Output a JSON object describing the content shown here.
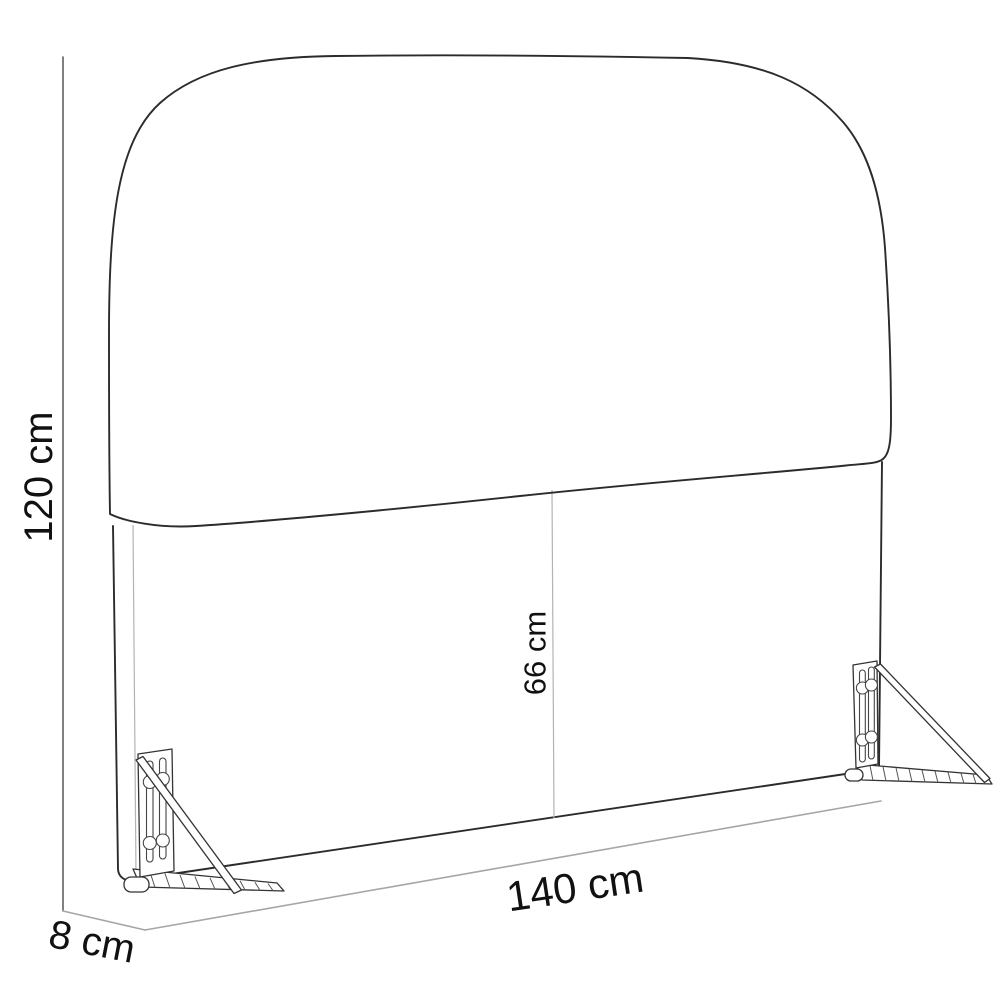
{
  "diagram": {
    "alt": "Line drawing of an upholstered headboard with two wall-mount brackets and dimension labels",
    "style": {
      "background": "#ffffff",
      "outline_color": "#2b2b2b",
      "seam_color": "#b3b3b3",
      "dimension_line_color": "#a6a6a6",
      "height_line_color": "#4a4a4a",
      "text_color": "#111111"
    },
    "dimensions": {
      "height": {
        "label": "120 cm",
        "value": 120,
        "unit": "cm",
        "orientation": "vertical-left"
      },
      "panel_height": {
        "label": "66 cm",
        "value": 66,
        "unit": "cm",
        "orientation": "vertical-center-seam"
      },
      "width": {
        "label": "140 cm",
        "value": 140,
        "unit": "cm",
        "orientation": "bottom-edge"
      },
      "depth": {
        "label": "8 cm",
        "value": 8,
        "unit": "cm",
        "orientation": "bottom-left-depth"
      }
    }
  }
}
